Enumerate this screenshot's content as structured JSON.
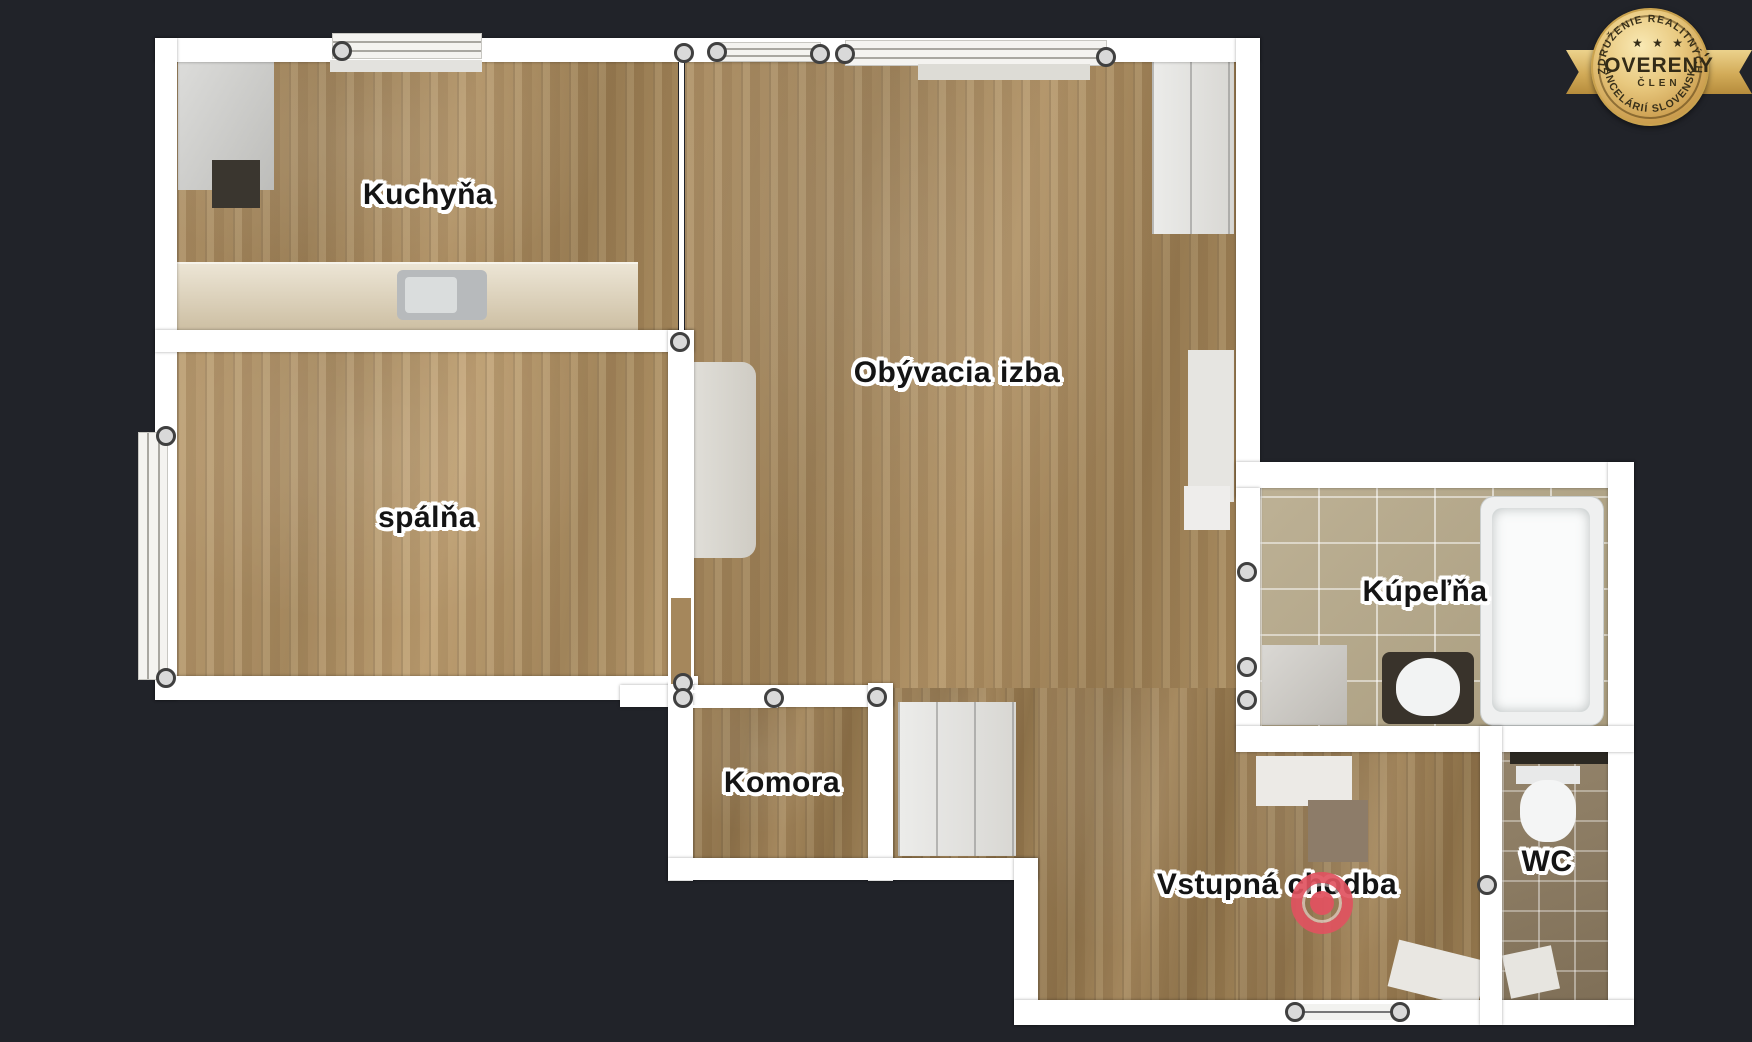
{
  "page": {
    "background": "#212329"
  },
  "badge": {
    "arc_top": "ZDRUŽENIE REALITNÝCH",
    "stars": "★ ★ ★",
    "title": "OVERENÝ",
    "subtitle": "ČLEN",
    "arc_bottom": "KANCELÁRIÍ SLOVENSKA",
    "gold": "#d8b367",
    "text_color": "#332b17"
  },
  "floorplan": {
    "wall_color": "#ffffff",
    "marker_color": "#e05260",
    "rooms": [
      {
        "id": "kuchyna",
        "label": "Kuchyňa"
      },
      {
        "id": "obyvacia",
        "label": "Obývacia izba"
      },
      {
        "id": "spalna",
        "label": "spálňa"
      },
      {
        "id": "komora",
        "label": "Komora"
      },
      {
        "id": "kupelna",
        "label": "Kúpeľňa"
      },
      {
        "id": "wc",
        "label": "WC"
      },
      {
        "id": "vstupna",
        "label": "Vstupná chodba"
      }
    ]
  }
}
